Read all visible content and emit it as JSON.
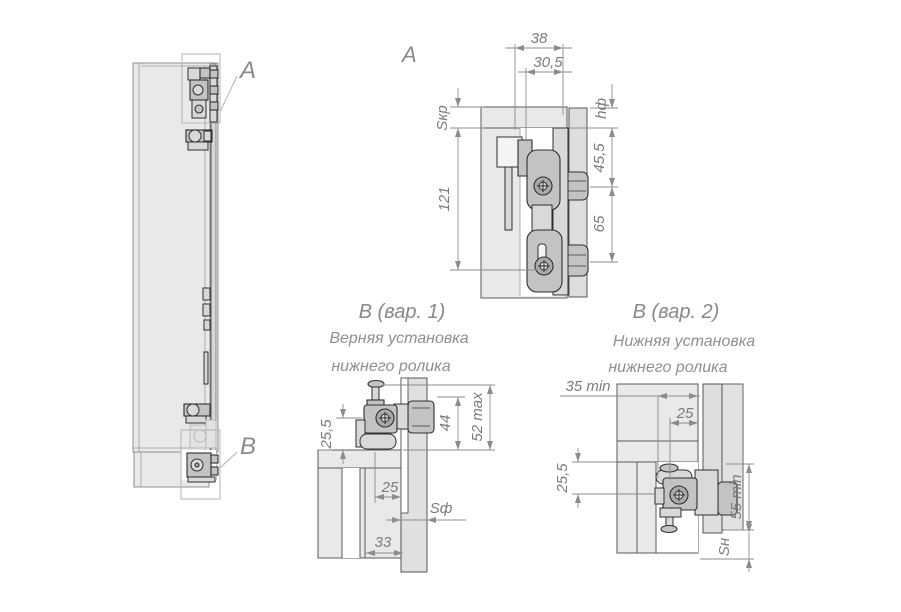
{
  "drawing": {
    "overview": {
      "callout_top": "A",
      "callout_bottom": "B"
    },
    "detail_a": {
      "label": "A",
      "dim_width_outer": "38",
      "dim_width_inner": "30,5",
      "dim_roof_thickness": "Sкр",
      "dim_facade": "hф",
      "dim_roller_top": "45,5",
      "dim_roller_spacing": "65",
      "dim_height": "121"
    },
    "detail_b1": {
      "label": "B (вар. 1)",
      "subtitle_line1": "Верняя установка",
      "subtitle_line2": "нижнего ролика",
      "dim_axis_height": "25,5",
      "dim_44": "44",
      "dim_52max": "52 max",
      "dim_25": "25",
      "dim_facade_thickness": "Sф",
      "dim_33": "33"
    },
    "detail_b2": {
      "label": "B (вар. 2)",
      "subtitle_line1": "Нижняя установка",
      "subtitle_line2": "нижнего ролика",
      "dim_35min": "35 min",
      "dim_25": "25",
      "dim_255": "25,5",
      "dim_55min": "55 min",
      "dim_bottom": "Sн"
    }
  },
  "colors": {
    "background": "#ffffff",
    "panel_fill": "#e9e9e9",
    "mechanism_fill": "#c3c3c3",
    "outline_dark": "#2f2f2f",
    "dimension_gray": "#8c8c8c",
    "text_gray": "#7b7b7b"
  }
}
